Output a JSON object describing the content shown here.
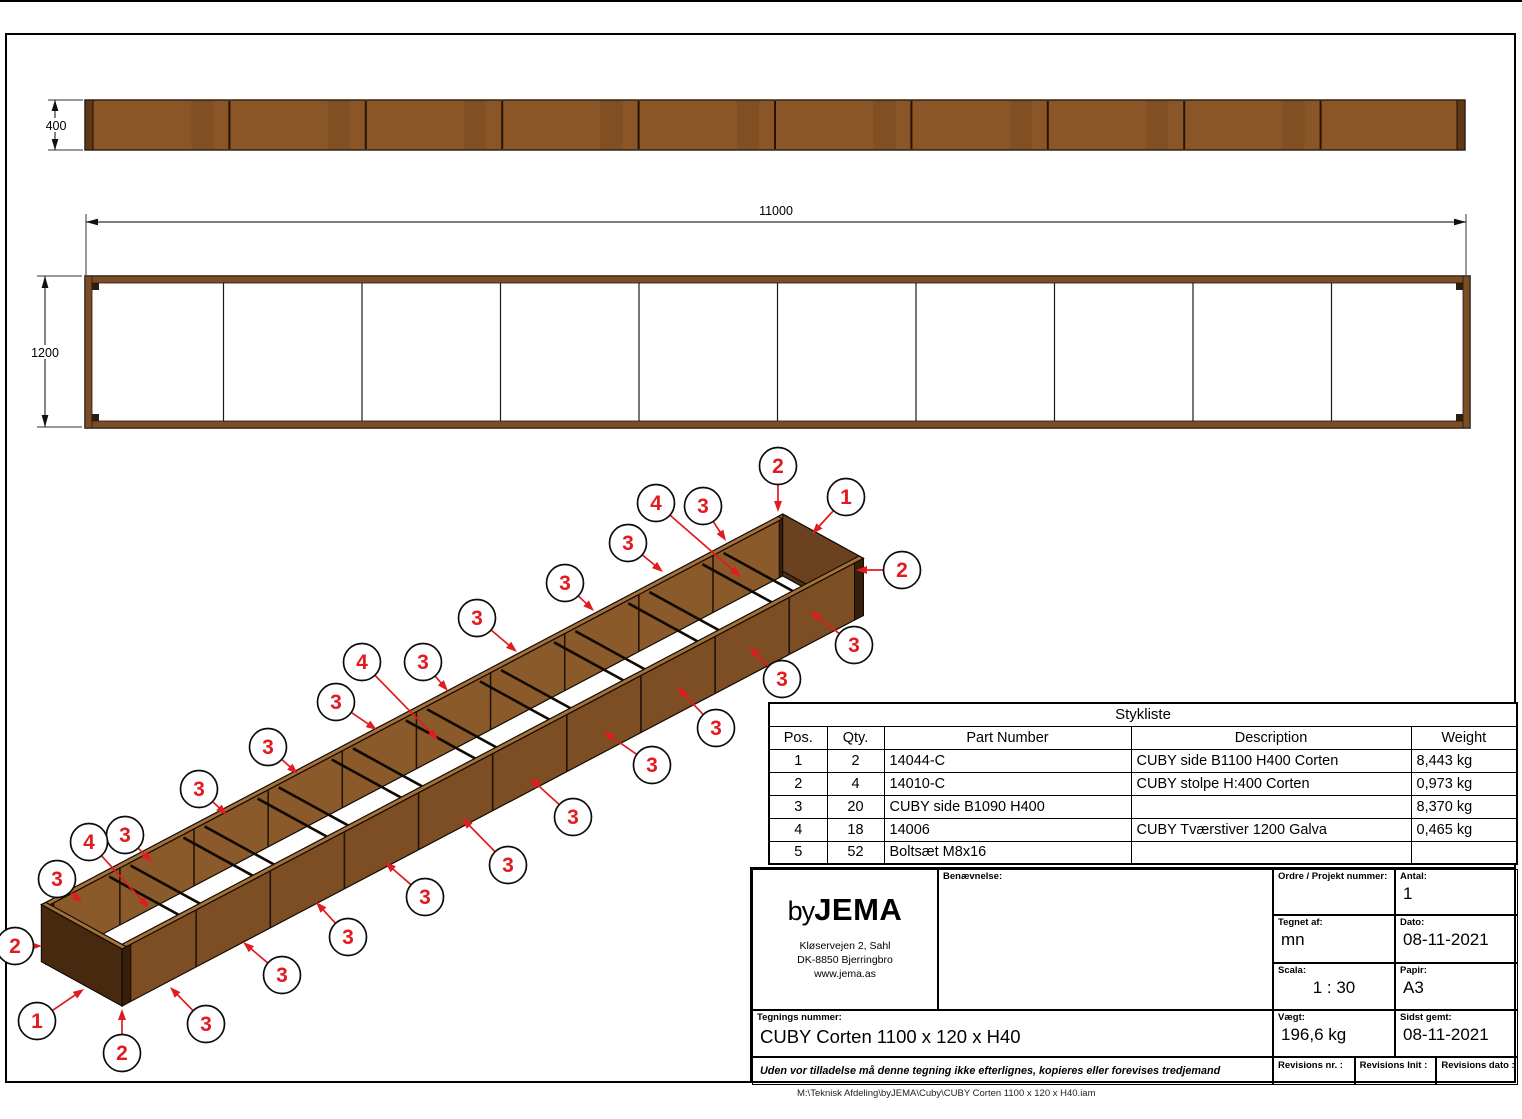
{
  "sheet": {
    "file_path": "M:\\Teknisk Afdeling\\byJEMA\\Cuby\\CUBY Corten 1100 x 120 x H40.iam"
  },
  "dimensions": {
    "front_height": "400",
    "plan_length": "11000",
    "plan_width": "1200"
  },
  "views": {
    "front_segments": 10,
    "plan_segments": 10,
    "iso_divisions": 9,
    "braces_per_division": 2
  },
  "colors": {
    "corten": "#8a5527",
    "corten_end": "#5f3817",
    "plan_band": "#7d4e23",
    "iso_front": "#7d4e23",
    "iso_back": "#8a5a2b",
    "iso_top": "#a5713a",
    "iso_end": "#6b4220",
    "iso_near": "#46290f",
    "iso_far_in": "#4e2f13",
    "iso_post": "#361f0b",
    "red": "#e11b20",
    "line": "#140c04"
  },
  "parts_table": {
    "title": "Stykliste",
    "columns": [
      "Pos.",
      "Qty.",
      "Part Number",
      "Description",
      "Weight"
    ],
    "rows": [
      [
        "1",
        "2",
        "14044-C",
        "CUBY side B1100 H400 Corten",
        "8,443 kg"
      ],
      [
        "2",
        "4",
        "14010-C",
        "CUBY stolpe H:400 Corten",
        "0,973 kg"
      ],
      [
        "3",
        "20",
        "CUBY side B1090 H400",
        "",
        "8,370 kg"
      ],
      [
        "4",
        "18",
        "14006",
        "CUBY Tværstiver 1200 Galva",
        "0,465 kg"
      ],
      [
        "5",
        "52",
        "Boltsæt M8x16",
        "",
        ""
      ]
    ]
  },
  "title_block": {
    "logo_by": "by",
    "logo_name": "JEMA",
    "address_lines": [
      "Kløservejen 2, Sahl",
      "DK-8850 Bjerringbro",
      "www.jema.as"
    ],
    "benaevnelse_label": "Benævnelse:",
    "ordre_label": "Ordre / Projekt nummer:",
    "ordre_value": "",
    "antal_label": "Antal:",
    "antal_value": "1",
    "tegnet_label": "Tegnet af:",
    "tegnet_value": "mn",
    "dato_label": "Dato:",
    "dato_value": "08-11-2021",
    "scala_label": "Scala:",
    "scala_value": "1 : 30",
    "papir_label": "Papir:",
    "papir_value": "A3",
    "tegnings_label": "Tegnings nummer:",
    "tegnings_value": "CUBY Corten 1100 x 120 x H40",
    "vaegt_label": "Vægt:",
    "vaegt_value": "196,6 kg",
    "sidst_label": "Sidst gemt:",
    "sidst_value": "08-11-2021",
    "rev_nr_label": "Revisions nr. :",
    "rev_init_label": "Revisions Init :",
    "rev_dato_label": "Revisions dato :",
    "disclaimer": "Uden vor tilladelse må denne tegning ikke efterlignes, kopieres eller forevises tredjemand"
  },
  "balloons": [
    {
      "n": "2",
      "cx": 778,
      "cy": 466,
      "tx": 778,
      "ty": 512
    },
    {
      "n": "1",
      "cx": 846,
      "cy": 497,
      "tx": 812,
      "ty": 534
    },
    {
      "n": "3",
      "cx": 703,
      "cy": 506,
      "tx": 726,
      "ty": 541
    },
    {
      "n": "4",
      "cx": 656,
      "cy": 503,
      "tx": 741,
      "ty": 577
    },
    {
      "n": "3",
      "cx": 628,
      "cy": 543,
      "tx": 663,
      "ty": 572
    },
    {
      "n": "2",
      "cx": 902,
      "cy": 570,
      "tx": 856,
      "ty": 570
    },
    {
      "n": "3",
      "cx": 565,
      "cy": 583,
      "tx": 594,
      "ty": 611
    },
    {
      "n": "3",
      "cx": 854,
      "cy": 645,
      "tx": 810,
      "ty": 611
    },
    {
      "n": "3",
      "cx": 477,
      "cy": 618,
      "tx": 517,
      "ty": 652
    },
    {
      "n": "3",
      "cx": 782,
      "cy": 679,
      "tx": 749,
      "ty": 647
    },
    {
      "n": "3",
      "cx": 423,
      "cy": 662,
      "tx": 448,
      "ty": 691
    },
    {
      "n": "4",
      "cx": 362,
      "cy": 662,
      "tx": 438,
      "ty": 740
    },
    {
      "n": "3",
      "cx": 716,
      "cy": 728,
      "tx": 677,
      "ty": 687
    },
    {
      "n": "3",
      "cx": 336,
      "cy": 702,
      "tx": 377,
      "ty": 730
    },
    {
      "n": "3",
      "cx": 652,
      "cy": 765,
      "tx": 603,
      "ty": 731
    },
    {
      "n": "3",
      "cx": 268,
      "cy": 747,
      "tx": 298,
      "ty": 774
    },
    {
      "n": "3",
      "cx": 573,
      "cy": 817,
      "tx": 530,
      "ty": 778
    },
    {
      "n": "3",
      "cx": 199,
      "cy": 789,
      "tx": 227,
      "ty": 815
    },
    {
      "n": "3",
      "cx": 508,
      "cy": 865,
      "tx": 462,
      "ty": 818
    },
    {
      "n": "3",
      "cx": 125,
      "cy": 835,
      "tx": 152,
      "ty": 862
    },
    {
      "n": "4",
      "cx": 89,
      "cy": 842,
      "tx": 149,
      "ty": 908
    },
    {
      "n": "3",
      "cx": 425,
      "cy": 897,
      "tx": 385,
      "ty": 862
    },
    {
      "n": "3",
      "cx": 57,
      "cy": 879,
      "tx": 82,
      "ty": 903
    },
    {
      "n": "3",
      "cx": 348,
      "cy": 937,
      "tx": 316,
      "ty": 902
    },
    {
      "n": "2",
      "cx": 15,
      "cy": 946,
      "tx": 42,
      "ty": 946
    },
    {
      "n": "3",
      "cx": 282,
      "cy": 975,
      "tx": 243,
      "ty": 942
    },
    {
      "n": "1",
      "cx": 37,
      "cy": 1021,
      "tx": 84,
      "ty": 989
    },
    {
      "n": "3",
      "cx": 206,
      "cy": 1024,
      "tx": 170,
      "ty": 987
    },
    {
      "n": "2",
      "cx": 122,
      "cy": 1053,
      "tx": 122,
      "ty": 1009
    }
  ]
}
